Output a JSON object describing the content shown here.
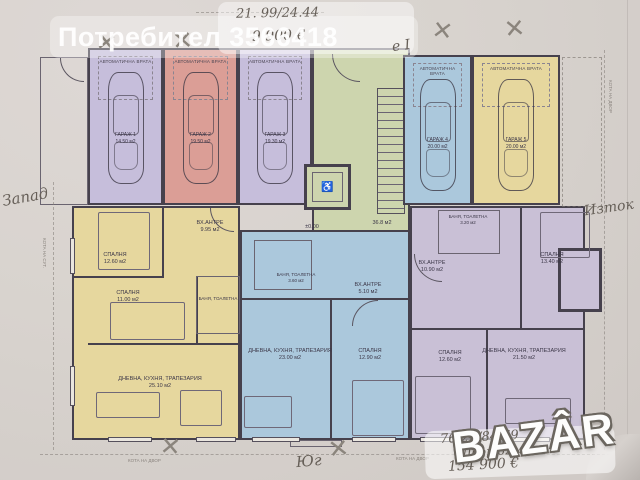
{
  "watermark": {
    "user_label": "Потребител 3566418",
    "brand": "BAZÂR"
  },
  "handwritten": {
    "top_dims": "21. 99/24.44",
    "top_price": "9 900 €",
    "entrance_mark": "е I",
    "side_west": "Запад",
    "side_east": "Изток",
    "side_south": "Юг",
    "bottom_dims": "76.21/84.69",
    "bottom_yard": "Двор 62м2",
    "bottom_price": "154 900 €",
    "x_mark": "✕"
  },
  "plan": {
    "garage_door_label": "АВТОМАТИЧНА ВРАТА",
    "garages": [
      {
        "name": "ГАРАЖ 1",
        "area": "14.50 м2"
      },
      {
        "name": "ГАРАЖ 2",
        "area": "19.50 м2"
      },
      {
        "name": "ГАРАЖ 3",
        "area": "19.30 м2"
      },
      {
        "name": "ГАРАЖ 4",
        "area": "20.00 м2"
      },
      {
        "name": "ГАРАЖ 5",
        "area": "20.00 м2"
      }
    ],
    "rooms": [
      {
        "name": "СПАЛНЯ",
        "area": "12.60 м2"
      },
      {
        "name": "СПАЛНЯ",
        "area": "11.00 м2"
      },
      {
        "name": "ВХ.АНТРЕ",
        "area": "9.95 м2"
      },
      {
        "name": "БАНЯ, ТОАЛЕТНА",
        "area": ""
      },
      {
        "name": "ДНЕВНА, КУХНЯ, ТРАПЕЗАРИЯ",
        "area": "25.10 м2"
      },
      {
        "name": "БАНЯ, ТОАЛЕТНА",
        "area": "3.60 м2"
      },
      {
        "name": "ВХ.АНТРЕ",
        "area": "5.10 м2"
      },
      {
        "name": "ДНЕВНА, КУХНЯ, ТРАПЕЗАРИЯ",
        "area": "23.00 м2"
      },
      {
        "name": "СПАЛНЯ",
        "area": "12.90 м2"
      },
      {
        "name": "БАНЯ, ТОАЛЕТНА",
        "area": "3.20 м2"
      },
      {
        "name": "ВХ.АНТРЕ",
        "area": "10.90 м2"
      },
      {
        "name": "СПАЛНЯ",
        "area": "13.40 м2"
      },
      {
        "name": "СПАЛНЯ",
        "area": "12.60 м2"
      },
      {
        "name": "ДНЕВНА, КУХНЯ, ТРАПЕЗАРИЯ",
        "area": "21.50 м2"
      }
    ],
    "core": {
      "stair_area": "36.8 м2",
      "level_mark": "±0.00",
      "elevator_icon": "♿"
    },
    "survey": {
      "right": "КОТА НА ДВОР",
      "bottom_left": "КОТА НА ДВОР",
      "bottom_right": "КОТА НА ДВОР",
      "left": "КОТА НА СУТ."
    }
  },
  "palette": {
    "lavender": "#c6bedb",
    "salmon": "#db9e96",
    "green": "#cdd5ae",
    "blue": "#abc8dc",
    "yellow": "#e6d79e",
    "purple": "#c9c0d6",
    "wall": "#46414d",
    "paper": "#d9d4cf"
  }
}
